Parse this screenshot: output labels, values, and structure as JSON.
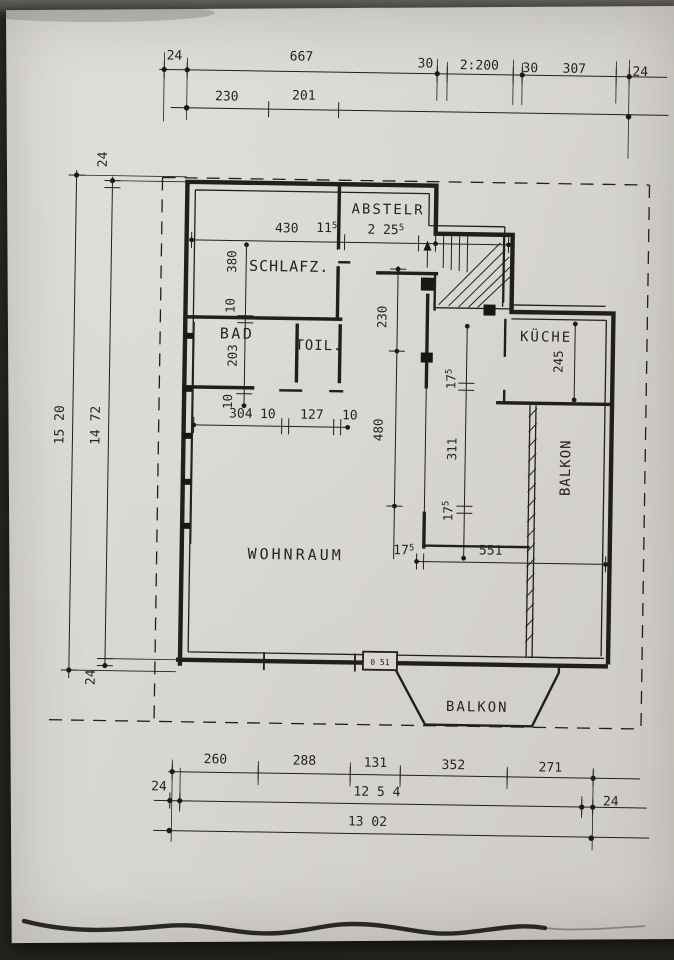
{
  "colors": {
    "paper": "#d9d6d2",
    "background": "#24221f",
    "ink": "#211f1b"
  },
  "chains": {
    "top_row1": {
      "left24": "24",
      "w667": "667",
      "w30a": "30",
      "w2200": "2:200",
      "w30b": "30",
      "w307": "307",
      "right24": "24"
    },
    "top_row2": {
      "w230": "230",
      "w201": "201"
    },
    "left": {
      "top24": "24",
      "total": "15 20",
      "inner": "14 72",
      "bottom24": "24"
    },
    "bottom_row1": {
      "w260": "260",
      "w288": "288",
      "w131": "131",
      "w352": "352",
      "w271": "271"
    },
    "bottom_row2": {
      "left24": "24",
      "total": "12 5 4",
      "right24": "24"
    },
    "bottom_row3": {
      "total": "13 02"
    }
  },
  "rooms": {
    "abstellraum": "ABSTELR",
    "schlafzimmer": "SCHLAFZ.",
    "bad": "BAD",
    "toilette": "TOIL.",
    "kueche": "KÜCHE",
    "balkon_ost": "BALKON",
    "wohnraum": "WOHNRAUM",
    "balkon_sued": "BALKON"
  },
  "interior": {
    "w430": "430",
    "w115": {
      "b": "11",
      "s": "5"
    },
    "w2255": {
      "b": "2 25",
      "s": "5"
    },
    "h380": "380",
    "h10a": "10",
    "h203": "203",
    "h10b": "10",
    "h230": "230",
    "h480": "480",
    "w304": "304",
    "w10a": "10",
    "w127": "127",
    "w10b": "10",
    "h245": "245",
    "h175a": {
      "b": "17",
      "s": "5"
    },
    "h311": "311",
    "h175b": {
      "b": "17",
      "s": "5"
    },
    "w175": {
      "b": "17",
      "s": "5"
    },
    "w551": "551",
    "door_mark": "0 51"
  }
}
